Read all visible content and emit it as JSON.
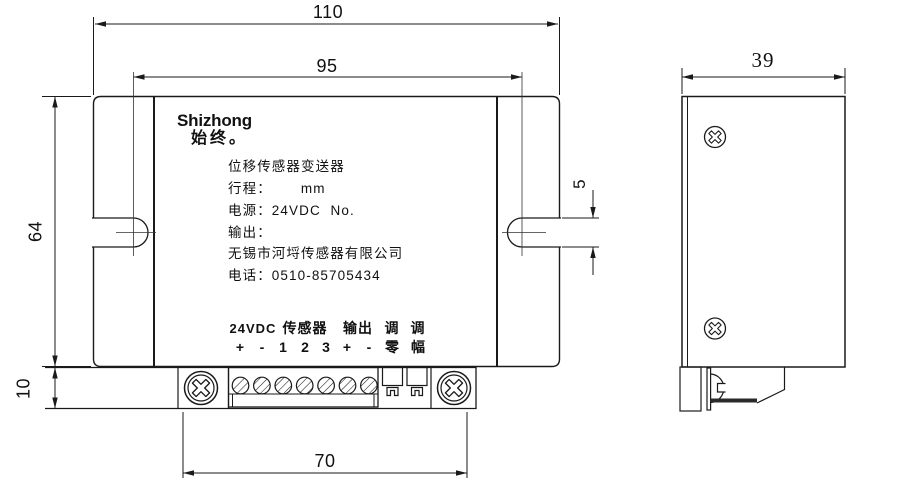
{
  "drawing": {
    "front_view": {
      "brand": {
        "latin": "Shizhong",
        "chinese": "始终。"
      },
      "label_lines": [
        "位移传感器变送器",
        "行程：      mm",
        "电源：24VDC  No.",
        "输出：",
        "无锡市河埒传感器有限公司",
        "电话：0510-85705434"
      ],
      "terminals": {
        "groups": [
          {
            "label": "24VDC"
          },
          {
            "label": "传感器"
          },
          {
            "label": "输出"
          },
          {
            "label": "调"
          },
          {
            "label": "调"
          }
        ],
        "pins": [
          "+",
          "-",
          "1",
          "2",
          "3",
          "+",
          "-",
          "零",
          "幅"
        ]
      },
      "dimensions": {
        "overall_width": "110",
        "hole_spacing": "95",
        "height": "64",
        "bottom_strip": "10",
        "screw_spacing": "70",
        "slot_width": "5"
      }
    },
    "side_view": {
      "dimensions": {
        "depth": "39"
      }
    },
    "colors": {
      "line": "#1a1a1a",
      "background": "#ffffff"
    }
  }
}
